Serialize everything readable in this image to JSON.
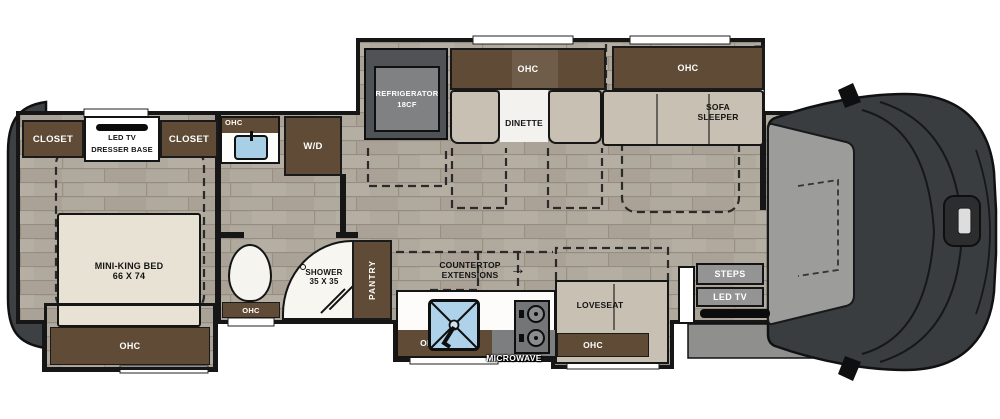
{
  "diagram_type": "rv-floorplan",
  "labels": {
    "closet": "CLOSET",
    "led_tv": "LED TV",
    "dresser_base": "DRESSER BASE",
    "ohc": "OHC",
    "wd": "W/D",
    "fridge1": "REFRIGERATOR",
    "fridge2": "18CF",
    "dinette": "DINETTE",
    "sofa1": "SOFA",
    "sofa2": "SLEEPER",
    "bed1": "MINI-KING BED",
    "bed2": "66 X 74",
    "shower1": "SHOWER",
    "shower2": "35 X 35",
    "pantry": "PANTRY",
    "counter1": "COUNTERTOP",
    "counter2": "EXTENSIONS",
    "arrow": "→",
    "loveseat": "LOVESEAT",
    "steps": "STEPS",
    "microwave": "MICROWAVE"
  },
  "colors": {
    "cabinet_brown": "#5f4b36",
    "cushion_tan": "#c8c0b2",
    "bed_beige": "#e8e2d4",
    "floor_wood": "#b0a99d",
    "wall_black": "#161616",
    "steps_gray": "#949494",
    "sink_blue": "#aed2e9",
    "fridge_gray": "#505356",
    "cab_dark": "#3a3d40",
    "cab_light": "#9c9c9a"
  }
}
